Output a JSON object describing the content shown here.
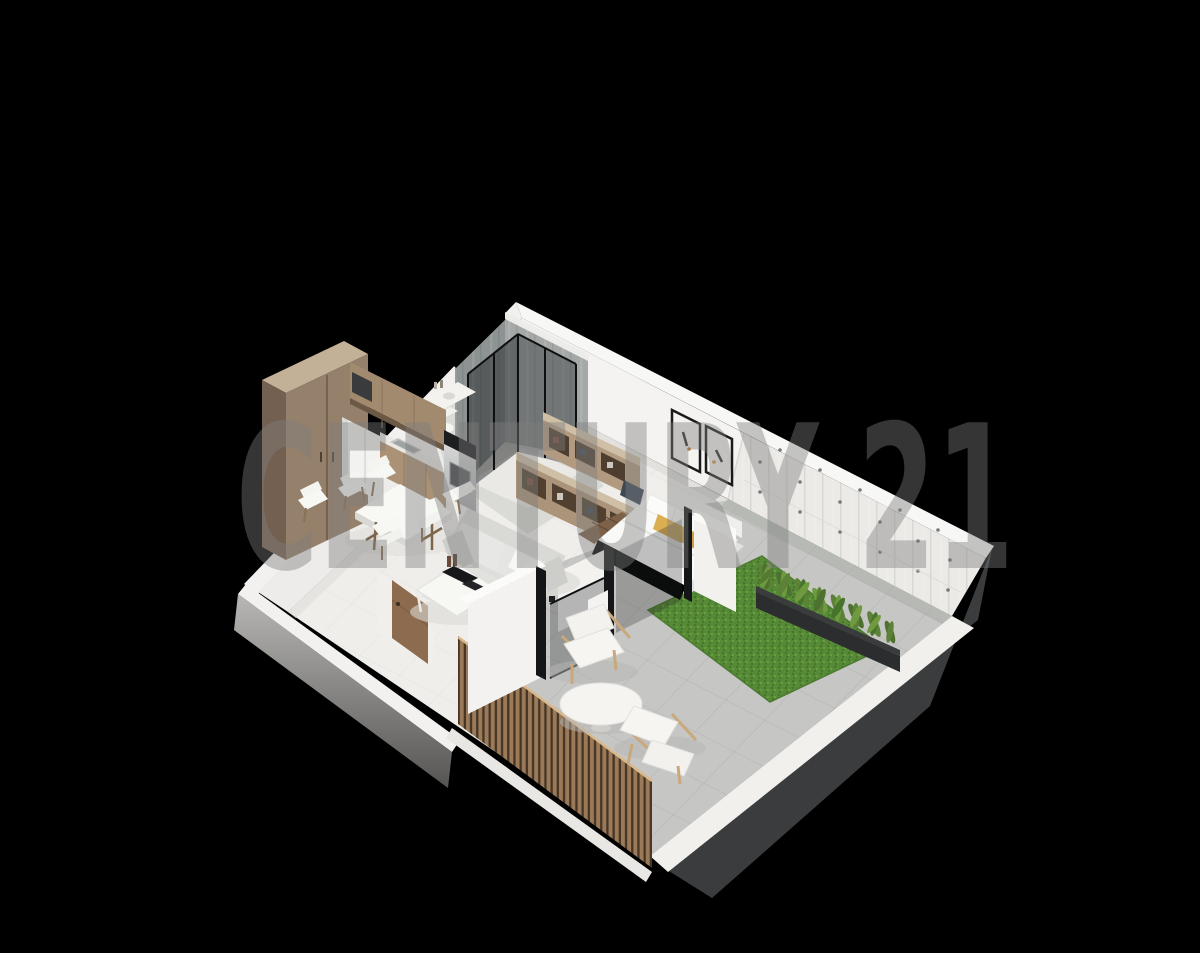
{
  "scene": {
    "description": "3D isometric cutaway render of a one-bedroom apartment with garden patio on a black background",
    "rooms": [
      "kitchen",
      "dining area",
      "living room",
      "bathroom",
      "walk-in closet",
      "bedroom",
      "patio",
      "garden"
    ],
    "objects": [
      "tall wardrobe cabinet",
      "upper kitchen cabinets",
      "refrigerator",
      "sink counter",
      "range with black cooktop",
      "dining table",
      "dining chairs",
      "sofa",
      "coffee table",
      "glass shower enclosure",
      "open closet shelving",
      "double bed with pillows",
      "framed wall art",
      "planter box with plants",
      "artificial grass",
      "outdoor armchairs",
      "round patio table",
      "wood slat fence",
      "entry door"
    ]
  },
  "watermark": {
    "text": "CENTURY 21",
    "color": "#7e7e7e",
    "opacity": "0.42"
  },
  "colors": {
    "background": "#000000",
    "floor": "#efeeeb",
    "wall_white": "#f4f3f1",
    "wall_band": "#f7f7f5",
    "concrete_panel": "#eceae6",
    "concrete_shower_dark": "#8d9392",
    "concrete_shower_light": "#a4a8a6",
    "patio_tile": "#c6c7c4",
    "grass": "#568a36",
    "charcoal_wall": "#3a3c3e",
    "wood_cabinet": "#95806b",
    "wood_shelf": "#b19a7f",
    "wood_fence": "#9b7a59",
    "wood_door": "#8d6b4e",
    "sofa_gray": "#dedede",
    "accent_mustard": "#dcae52",
    "plant_green": "#5d8136",
    "glass_dark": "#16191b"
  }
}
